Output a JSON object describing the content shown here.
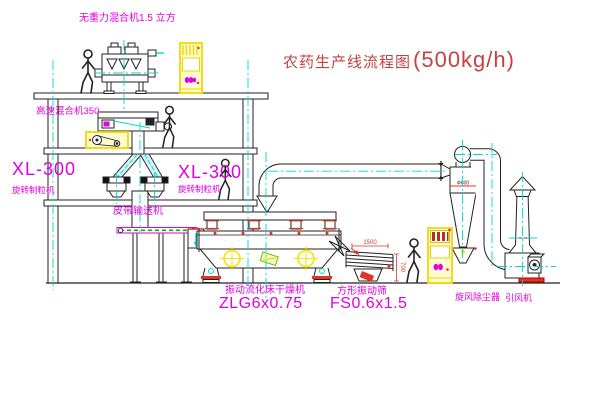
{
  "title": {
    "text": "农药生产线流程图",
    "capacity": "(500kg/h)"
  },
  "labels": {
    "gravity_free_mixer": "无重力混合机1.5 立方",
    "high_speed_mixer": "高速混合机350",
    "granulator_left_model": "XL-300",
    "granulator_left_name": "旋转制粒机",
    "granulator_mid_model": "XL-300",
    "granulator_mid_name": "旋转制粒机",
    "belt_conveyor": "皮带输送机",
    "dryer_name": "振动流化床干燥机",
    "dryer_model": "ZLG6x0.75",
    "sieve_name": "方形振动筛",
    "sieve_model": "FS0.6x1.5",
    "cyclone_name": "旋风除尘器",
    "fan_name": "引风机"
  },
  "dimensions": {
    "sieve_length": "1500",
    "sieve_height": "700",
    "cyclone_dia": "Φ600"
  },
  "colors": {
    "label_magenta": "#e000e0",
    "title_red": "#c84040",
    "centerline_cyan": "#00d8d8",
    "outline_black": "#222222",
    "cabinet_yellow": "#f2d800",
    "detail_red": "#e43322",
    "belt_green": "#00b400"
  }
}
